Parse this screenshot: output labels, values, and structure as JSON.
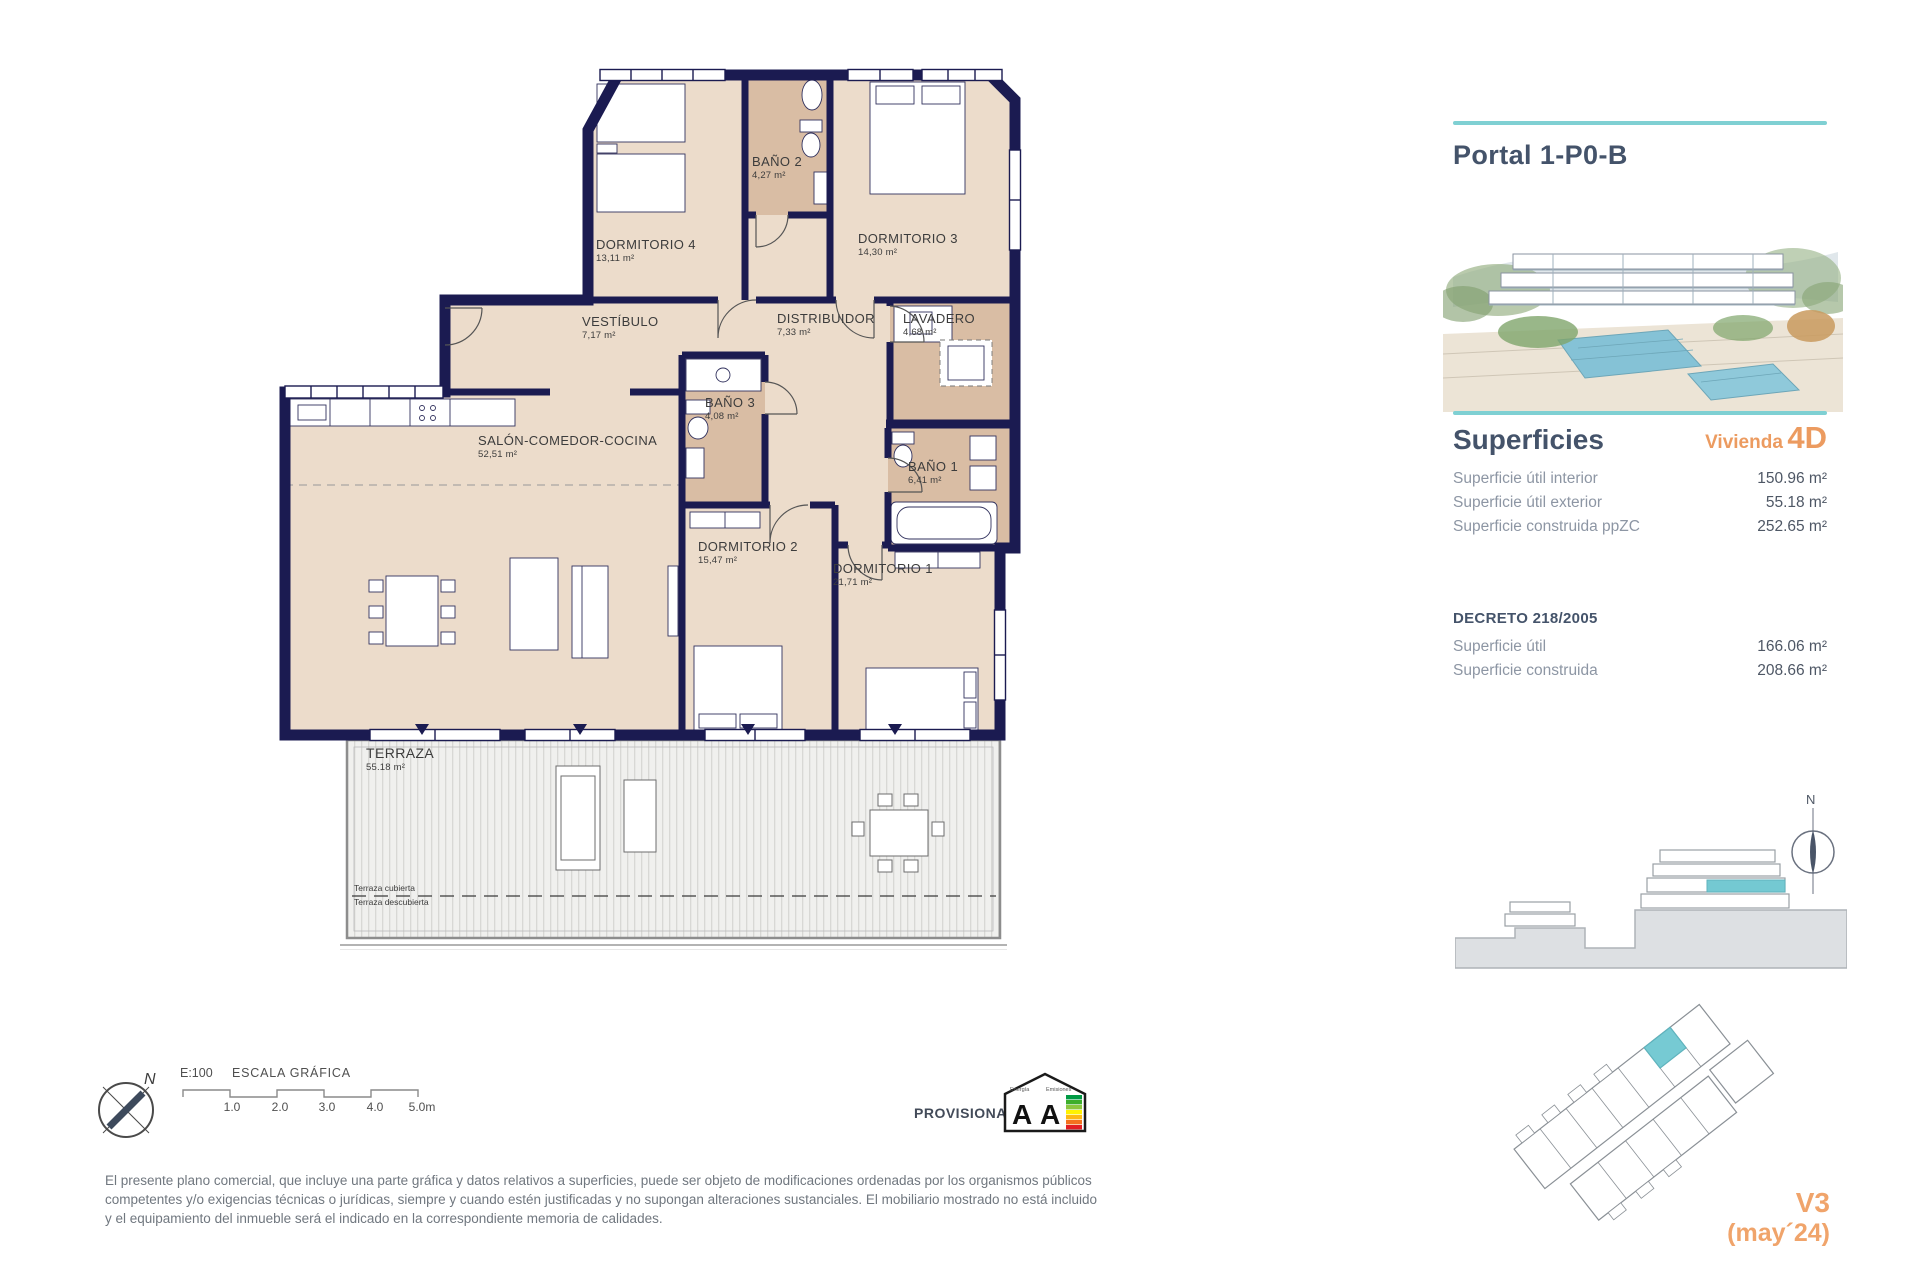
{
  "colors": {
    "accent_teal": "#7fd0d3",
    "accent_orange": "#ec9b60",
    "wall_navy": "#1b1b51"
  },
  "plan": {
    "rooms": [
      {
        "name": "DORMITORIO 4",
        "area": "13,11 m²"
      },
      {
        "name": "BAÑO 2",
        "area": "4,27 m²"
      },
      {
        "name": "DORMITORIO 3",
        "area": "14,30 m²"
      },
      {
        "name": "VESTÍBULO",
        "area": "7,17 m²"
      },
      {
        "name": "DISTRIBUIDOR",
        "area": "7,33 m²"
      },
      {
        "name": "LAVADERO",
        "area": "4,68 m²"
      },
      {
        "name": "BAÑO 3",
        "area": "4,08 m²"
      },
      {
        "name": "SALÓN-COMEDOR-COCINA",
        "area": "52,51 m²"
      },
      {
        "name": "BAÑO 1",
        "area": "6,41 m²"
      },
      {
        "name": "DORMITORIO 2",
        "area": "15,47 m²"
      },
      {
        "name": "DORMITORIO 1",
        "area": "21,71 m²"
      },
      {
        "name": "TERRAZA",
        "area": "55.18 m²"
      }
    ],
    "terrace_note_covered": "Terraza cubierta",
    "terrace_note_uncovered": "Terraza descubierta"
  },
  "sidebar": {
    "title": "Portal 1-P0-B",
    "superficies_heading": "Superficies",
    "vivienda_label": "Vivienda",
    "vivienda_value": "4D",
    "superficies_rows": [
      {
        "label": "Superficie útil interior",
        "value": "150.96 m²"
      },
      {
        "label": "Superficie útil exterior",
        "value": "55.18 m²"
      },
      {
        "label": "Superficie construida ppZC",
        "value": "252.65 m²"
      }
    ],
    "decreto_heading": "DECRETO 218/2005",
    "decreto_rows": [
      {
        "label": "Superficie útil",
        "value": "166.06 m²"
      },
      {
        "label": "Superficie construida",
        "value": "208.66 m²"
      }
    ],
    "version": "V3",
    "version_date": "(may´24)"
  },
  "footer": {
    "scale_label": "E:100",
    "scale_title": "ESCALA GRÁFICA",
    "scale_ticks": [
      "1.0",
      "2.0",
      "3.0",
      "4.0",
      "5.0m"
    ],
    "provisional": "PROVISIONAL",
    "energy_letter": "A",
    "energy_word_1": "Energía",
    "energy_word_2": "Emisiones",
    "compass_north": "N",
    "disclaimer": "El presente plano comercial, que incluye una parte gráfica y datos relativos a superficies, puede ser objeto de modificaciones ordenadas por los organismos públicos competentes y/o exigencias técnicas o jurídicas, siempre y cuando estén justificadas y no supongan alteraciones sustanciales. El mobiliario mostrado no está incluido y el equipamiento del inmueble será el indicado en la correspondiente memoria de calidades."
  }
}
